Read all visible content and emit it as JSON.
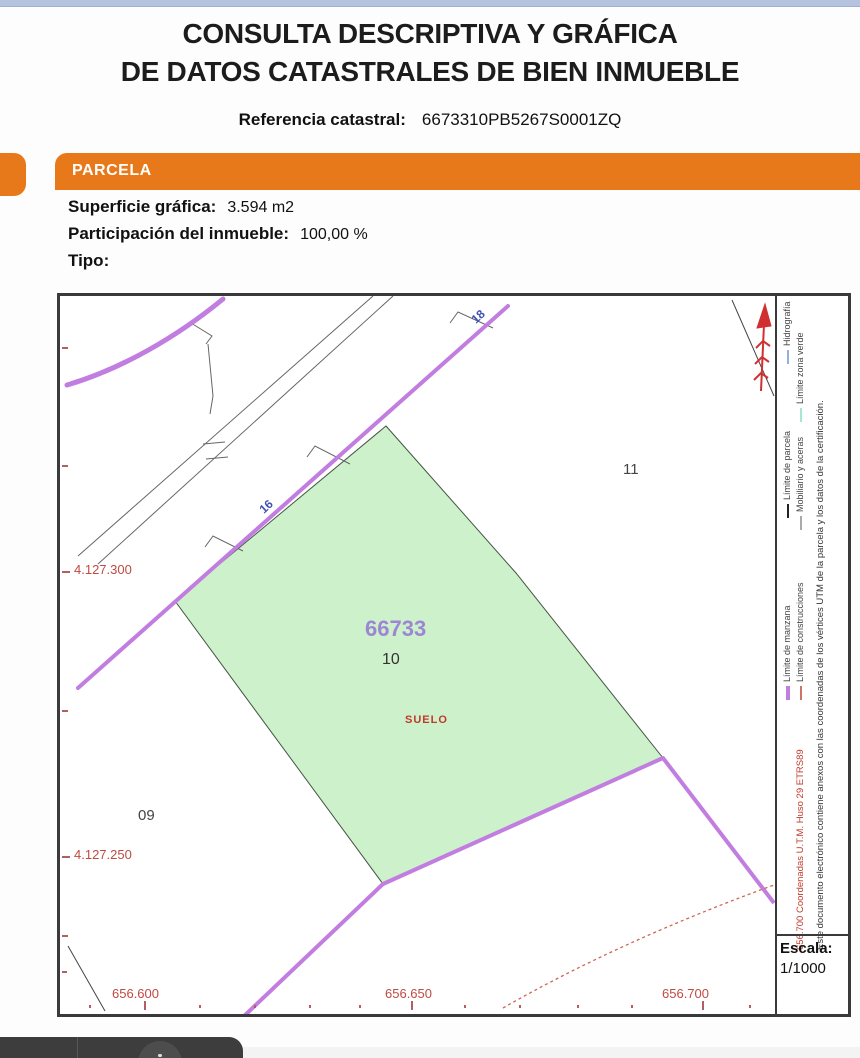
{
  "header": {
    "title_line1": "CONSULTA DESCRIPTIVA Y GRÁFICA",
    "title_line2": "DE DATOS CATASTRALES DE BIEN INMUEBLE",
    "ref_label": "Referencia catastral:",
    "ref_value": "6673310PB5267S0001ZQ"
  },
  "parcel_section": {
    "bar_label": "PARCELA",
    "fields": [
      {
        "label": "Superficie gráfica:",
        "value": "3.594 m2"
      },
      {
        "label": "Participación del inmueble:",
        "value": "100,00 %"
      },
      {
        "label": "Tipo:",
        "value": ""
      }
    ]
  },
  "map": {
    "parcel_code": "66733",
    "parcel_number": "10",
    "land_use": "SUELO",
    "neighbor_parcel_right": "11",
    "neighbor_parcel_left": "09",
    "street_number_top": "18",
    "street_number_mid": "16",
    "y_coord_top": "4.127.300",
    "y_coord_bottom": "4.127.250",
    "x_coord_1": "656.600",
    "x_coord_2": "656.650",
    "x_coord_3": "656.700",
    "colors": {
      "parcel_fill": "#cdf2cb",
      "block_limit_purple": "#c27de0",
      "street_number_blue": "#4053b5",
      "coordinate_red": "#c04a42",
      "north_arrow_red": "#d03030"
    }
  },
  "legend": {
    "items": [
      {
        "label": "Límite de manzana",
        "color": "#c27de0"
      },
      {
        "label": "Límite de construcciones",
        "color": "#cc7566"
      },
      {
        "label": "Límite de parcela",
        "color": "#222222"
      },
      {
        "label": "Mobiliario y aceras",
        "color": "#aaaaaa"
      },
      {
        "label": "Hidrografía",
        "color": "#93b1dd"
      },
      {
        "label": "Límite zona verde",
        "color": "#a5e6d4"
      }
    ],
    "utm_note": "656.700 Coordenadas U.T.M. Huso 29 ETRS89",
    "cert_note": "Este documento electrónico contiene anexos con las coordenadas de los vértices UTM de la parcela y los datos de la certificación."
  },
  "scale": {
    "label": "Escala:",
    "value": "1/1000"
  },
  "section_colors": {
    "orange": "#e8791a",
    "top_strip": "#b6c3de"
  }
}
